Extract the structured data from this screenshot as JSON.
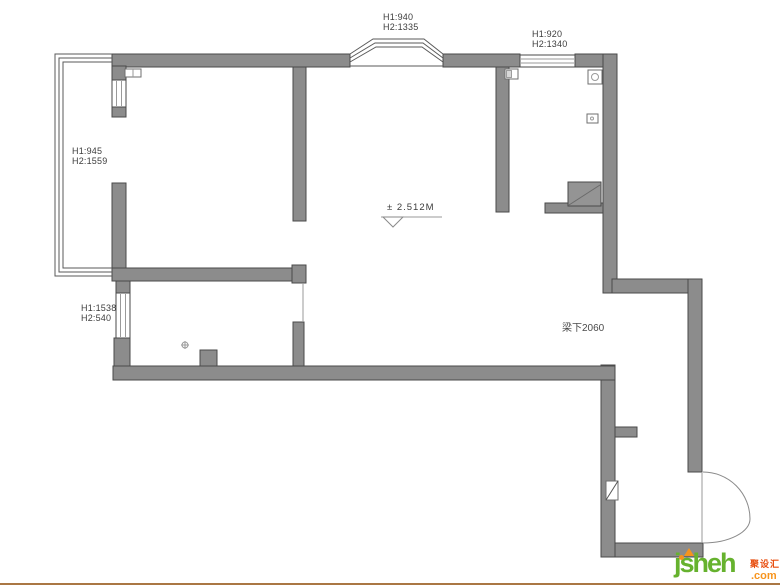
{
  "plan": {
    "window_labels": {
      "bay": {
        "line1": "H1:940",
        "line2": "H2:1335"
      },
      "top_right": {
        "line1": "H1:920",
        "line2": "H2:1340"
      },
      "left": {
        "line1": "H1:945",
        "line2": "H2:1559"
      },
      "lower_left": {
        "line1": "H1:1538",
        "line2": "H2:540"
      }
    },
    "elevation_marker": "± 2.512M",
    "beam_note": "梁下2060",
    "colors": {
      "wall_fill": "#8c8c8c",
      "wall_stroke": "#4a4a4a",
      "label_text": "#3d3d3d"
    }
  },
  "watermark": {
    "brand": "jsheh",
    "suffix": ".com",
    "cjk_tag": "聚设汇",
    "brand_color": "#66b22e",
    "accent_color": "#f7941d",
    "cjk_color": "#e84e0f"
  }
}
